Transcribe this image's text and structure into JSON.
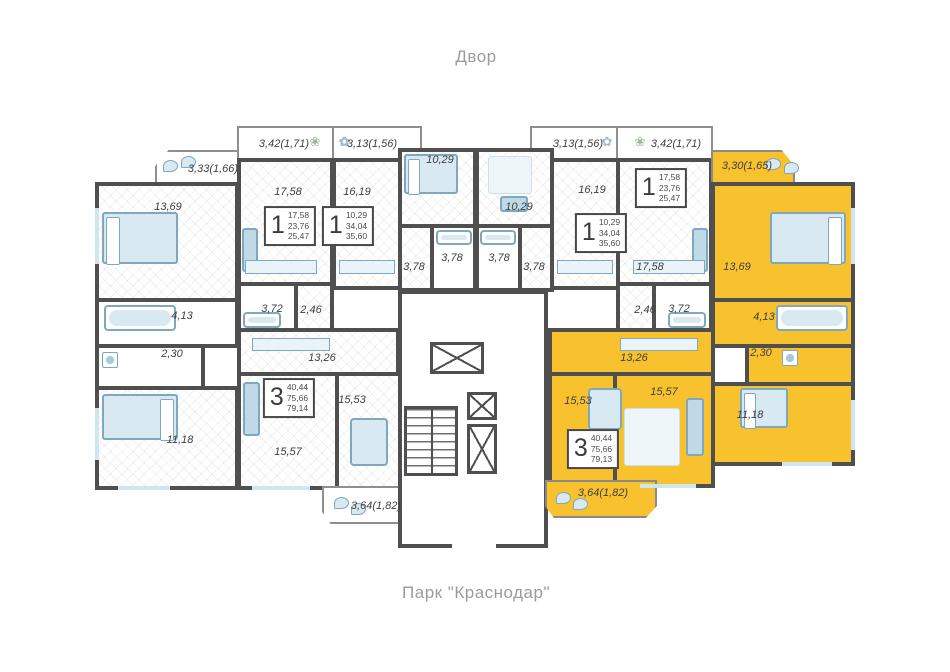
{
  "captions": {
    "top": "Двор",
    "bottom": "Парк \"Краснодар\""
  },
  "colors": {
    "highlight": "#F8C12E",
    "wall": "#4F4F4F",
    "furniture": "#D8E9F1",
    "caption": "#9B9B9B"
  },
  "badges": {
    "apt1": {
      "rooms": "3",
      "v1": "40,44",
      "v2": "75,66",
      "v3": "79,14"
    },
    "apt2": {
      "rooms": "1",
      "v1": "17,58",
      "v2": "23,76",
      "v3": "25,47"
    },
    "apt3": {
      "rooms": "1",
      "v1": "10,29",
      "v2": "34,04",
      "v3": "35,60"
    },
    "apt4": {
      "rooms": "1",
      "v1": "10,29",
      "v2": "34,04",
      "v3": "35,60"
    },
    "apt5": {
      "rooms": "1",
      "v1": "17,58",
      "v2": "23,76",
      "v3": "25,47"
    },
    "apt6": {
      "rooms": "3",
      "v1": "40,44",
      "v2": "75,66",
      "v3": "79,13"
    }
  },
  "rooms": {
    "apt1": {
      "balcony_top": "3,33(1,66)",
      "bedroom_top": "13,69",
      "bath": "4,13",
      "wc": "2,30",
      "bedroom": "11,18",
      "living": "15,57",
      "kitchen": "15,53",
      "hall": "13,26",
      "balcony_bottom": "3,64(1,82)"
    },
    "apt2": {
      "balcony": "3,42(1,71)",
      "living": "17,58",
      "bath": "3,72",
      "wc": "2,46"
    },
    "apt3": {
      "balcony": "3,13(1,56)",
      "living": "16,19",
      "bedroom": "10,29",
      "bath": "3,78",
      "hall": "3,78"
    },
    "apt4": {
      "balcony": "3,13(1,56)",
      "living": "16,19",
      "bedroom": "10,29",
      "bath": "3,78",
      "hall": "3,78"
    },
    "apt5": {
      "balcony": "3,42(1,71)",
      "living": "17,58",
      "bath": "3,72",
      "wc": "2,46"
    },
    "apt6": {
      "balcony_top": "3,30(1,65)",
      "bedroom_top": "13,69",
      "bath": "4,13",
      "wc": "2,30",
      "bedroom": "11,18",
      "living": "15,57",
      "kitchen": "15,53",
      "hall": "13,26",
      "balcony_bottom": "3,64(1,82)"
    }
  }
}
